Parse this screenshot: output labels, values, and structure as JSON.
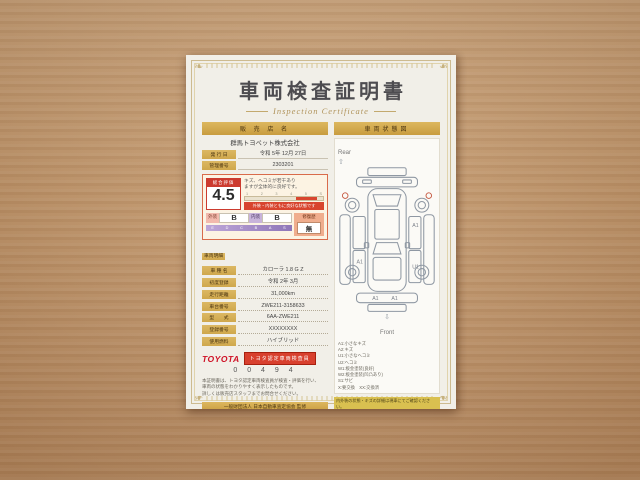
{
  "title": {
    "main": "車両検査証明書",
    "sub": "Inspection Certificate"
  },
  "seller": {
    "header": "販 売 店 名",
    "name": "群馬トヨペット株式会社",
    "rows": [
      {
        "label": "発 行 日",
        "value": "令和 5年 12月 27日"
      },
      {
        "label": "管理番号",
        "value": "2303201"
      }
    ]
  },
  "evaluation": {
    "label": "総合評価",
    "score": "4.5",
    "comment_line1": "キズ、ヘコミが若干あり",
    "comment_line2": "ますが全体的に良好です。",
    "scale_ticks": [
      "1",
      "2",
      "3",
      "4",
      "5",
      "S"
    ],
    "scale_caption": "外装・内装ともに良好な状態です",
    "exterior_label": "外装",
    "exterior_grade": "B",
    "interior_label": "内装",
    "interior_grade": "B",
    "grade_scale": [
      "E",
      "D",
      "C",
      "B",
      "A",
      "S"
    ],
    "repair_label": "修復歴",
    "repair_value": "無"
  },
  "details": {
    "section": "車両明細",
    "rows": [
      {
        "label": "車 種 名",
        "value": "カローラ 1.8 G Z"
      },
      {
        "label": "初度登録",
        "value": "令和 2年 3月"
      },
      {
        "label": "走行距離",
        "value": "31,000km"
      },
      {
        "label": "車台番号",
        "value": "ZWE211-3158633"
      },
      {
        "label": "型　　式",
        "value": "6AA-ZWE211"
      },
      {
        "label": "登録番号",
        "value": "XXXXXXXX"
      },
      {
        "label": "使用燃料",
        "value": "ハイブリッド"
      }
    ]
  },
  "inspector": {
    "brand": "TOYOTA",
    "badge": "トヨタ認定車両検査員",
    "number": "0 0 4 9 4",
    "notes": [
      "本証明書は、トヨタ認定車両検査員が検査・評価を行い、",
      "車両の状態をわかりやすく表示したものです。",
      "詳しくは販売店スタッフまでお問合せください。"
    ]
  },
  "footer_left": {
    "bar": "一般財団法人 日本自動車査定協会 監修",
    "notes": [
      "※本証明書は検査時点の車両状態を表示したものです。",
      "※保証内容については販売店にてご確認ください。"
    ]
  },
  "condition": {
    "header": "車両状態図",
    "rear": "Rear",
    "front": "Front",
    "rear_arrow": "⇧",
    "front_arrow": "⇩",
    "marks": {
      "m1": "A1",
      "m2": "A1",
      "m3": "U1",
      "m4": "A1",
      "m5": "A1"
    },
    "legend": [
      "A1:小さなキズ",
      "A2:キズ",
      "U1:小さなヘコミ",
      "U2:ヘコミ",
      "W1:板金塗装(良好)",
      "W2:板金塗装(凹凸あり)",
      "S1:サビ",
      "X:要交換　XX:交換済"
    ],
    "highlight": "内外装の状態・キズの詳細は現車にてご確認ください。",
    "notes": [
      "※図の表示内容は検査時点のものです。",
      "※お問合せは販売店スタッフまで。"
    ],
    "bar": "日本自動車査定協会 定期検査",
    "jaai": "JAAI",
    "side_notes": [
      "本証明書の内容に関する",
      "お問合せは販売店まで",
      "ご連絡ください。"
    ]
  }
}
